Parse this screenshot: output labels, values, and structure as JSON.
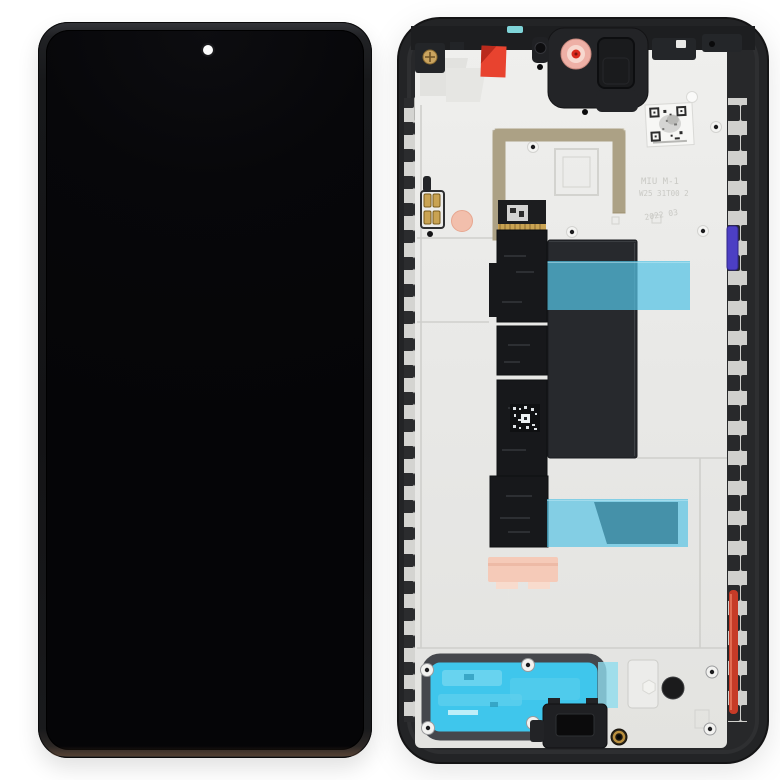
{
  "image": {
    "subject": "Smartphone LCD display and digitizer full assembly with frame, front view (left) and rear view (right)",
    "views": [
      "front display with punch-hole camera",
      "rear midframe with flex cable, tapes and stickers"
    ]
  },
  "markings": {
    "etched_line1": "MIU M-1",
    "etched_line2": "W25 31T00 2",
    "etched_line3": "2022 03"
  },
  "colors": {
    "bg": "#ffffff",
    "frame-dark": "#232426",
    "screen-black": "#070708",
    "plate": "#e9e9e7",
    "plate-line": "#cfcfcc",
    "cyan-tape": "#54c3e4",
    "speaker-cyan": "#3fc6ec",
    "flex-black": "#17181b",
    "battery-dark": "#27292d",
    "gold": "#c9a352",
    "antenna-gold": "#b3a383",
    "pink-pad": "#f5cab8",
    "camera-pink": "#eeb0a6",
    "camera-red": "#da291c",
    "red-sticker": "#e8432f",
    "red-strip": "#c63b27",
    "purple-strip": "#4c3fc4",
    "teal-strip": "#7fd4d8"
  }
}
